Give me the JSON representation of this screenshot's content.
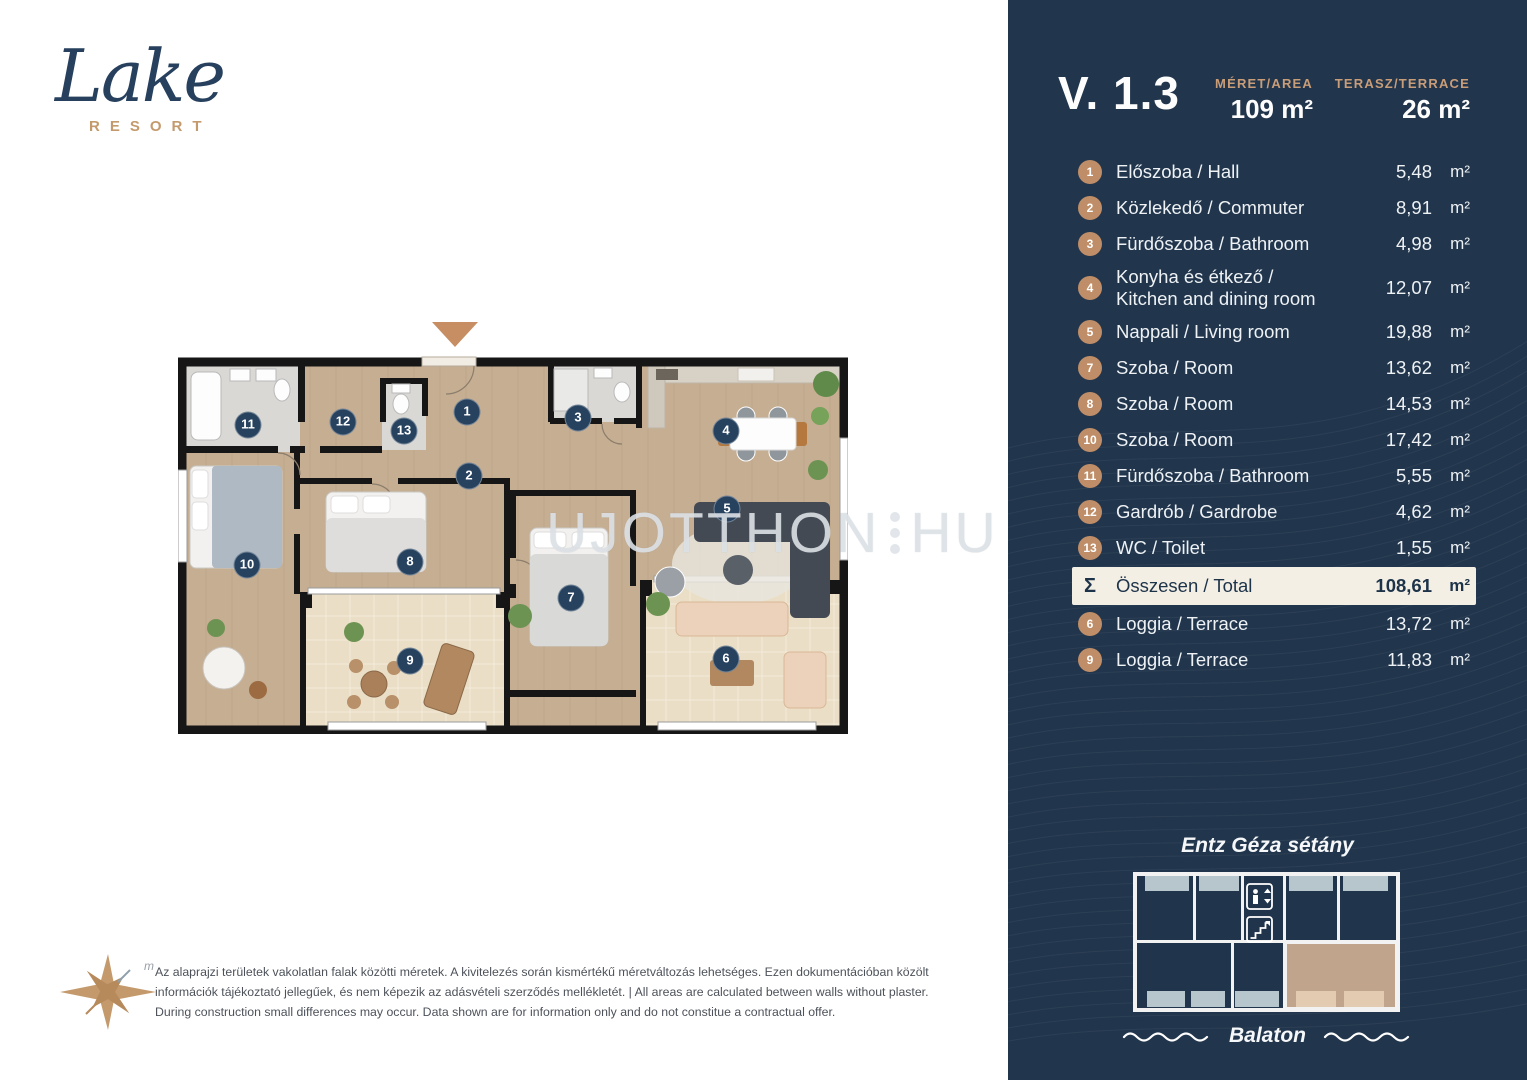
{
  "logo": {
    "name": "Lake",
    "subtitle": "RESORT"
  },
  "watermark": {
    "left": "UJOTTHON",
    "right": "HU"
  },
  "plan": {
    "badges": [
      {
        "number": "11",
        "x": 70,
        "y": 105
      },
      {
        "number": "12",
        "x": 165,
        "y": 102
      },
      {
        "number": "13",
        "x": 226,
        "y": 111
      },
      {
        "number": "1",
        "x": 289,
        "y": 92
      },
      {
        "number": "3",
        "x": 400,
        "y": 98
      },
      {
        "number": "4",
        "x": 548,
        "y": 111
      },
      {
        "number": "2",
        "x": 291,
        "y": 156
      },
      {
        "number": "5",
        "x": 549,
        "y": 189
      },
      {
        "number": "8",
        "x": 232,
        "y": 242
      },
      {
        "number": "10",
        "x": 69,
        "y": 245
      },
      {
        "number": "7",
        "x": 393,
        "y": 278
      },
      {
        "number": "9",
        "x": 232,
        "y": 341
      },
      {
        "number": "6",
        "x": 548,
        "y": 339
      }
    ]
  },
  "compass": {
    "label": "m"
  },
  "disclaimer": {
    "text": "Az alaprajzi területek vakolatlan falak közötti méretek. A kivitelezés során kismértékű méretváltozás lehetséges. Ezen dokumentációban közölt\ninformációk tájékoztató jellegűek, és nem képezik az adásvételi szerződés mellékletét. | All areas are calculated between walls without plaster.\nDuring construction small differences may occur. Data shown are for information only and do not constitue a contractual offer."
  },
  "panel": {
    "unit_code": "V. 1.3",
    "unit": "m²",
    "stats": [
      {
        "label": "MÉRET/AREA",
        "value": "109 m²"
      },
      {
        "label": "TERASZ/TERRACE",
        "value": "26 m²"
      }
    ],
    "rooms": [
      {
        "num": "1",
        "label": "Előszoba / Hall",
        "area": "5,48"
      },
      {
        "num": "2",
        "label": "Közlekedő / Commuter",
        "area": "8,91"
      },
      {
        "num": "3",
        "label": "Fürdőszoba / Bathroom",
        "area": "4,98"
      },
      {
        "num": "4",
        "label": "Konyha  és étkező /\nKitchen and dining room",
        "area": "12,07"
      },
      {
        "num": "5",
        "label": "Nappali / Living room",
        "area": "19,88"
      },
      {
        "num": "7",
        "label": "Szoba / Room",
        "area": "13,62"
      },
      {
        "num": "8",
        "label": "Szoba / Room",
        "area": "14,53"
      },
      {
        "num": "10",
        "label": "Szoba / Room",
        "area": "17,42"
      },
      {
        "num": "11",
        "label": "Fürdőszoba / Bathroom",
        "area": "5,55"
      },
      {
        "num": "12",
        "label": "Gardrób / Gardrobe",
        "area": "4,62"
      },
      {
        "num": "13",
        "label": "WC / Toilet",
        "area": "1,55"
      },
      {
        "num": "Σ",
        "label": "Összesen / Total",
        "area": "108,61",
        "total": true
      },
      {
        "num": "6",
        "label": "Loggia / Terrace",
        "area": "13,72"
      },
      {
        "num": "9",
        "label": "Loggia / Terrace",
        "area": "11,83"
      }
    ],
    "locator": {
      "street": "Entz Géza sétány",
      "lake": "Balaton"
    }
  },
  "colors": {
    "panel_navy": "#21354c",
    "accent_tan": "#bf8e68",
    "total_row_bg": "#f4efe5",
    "badge_navy": "#27425f",
    "plan_wood": "#c6ae92",
    "plan_bath_gray": "#d9d8d4",
    "plan_loggia_cream": "#eadfc6",
    "locator_terrace_gray": "#b7c5cd",
    "locator_unit_highlight": "#c0a48b"
  }
}
